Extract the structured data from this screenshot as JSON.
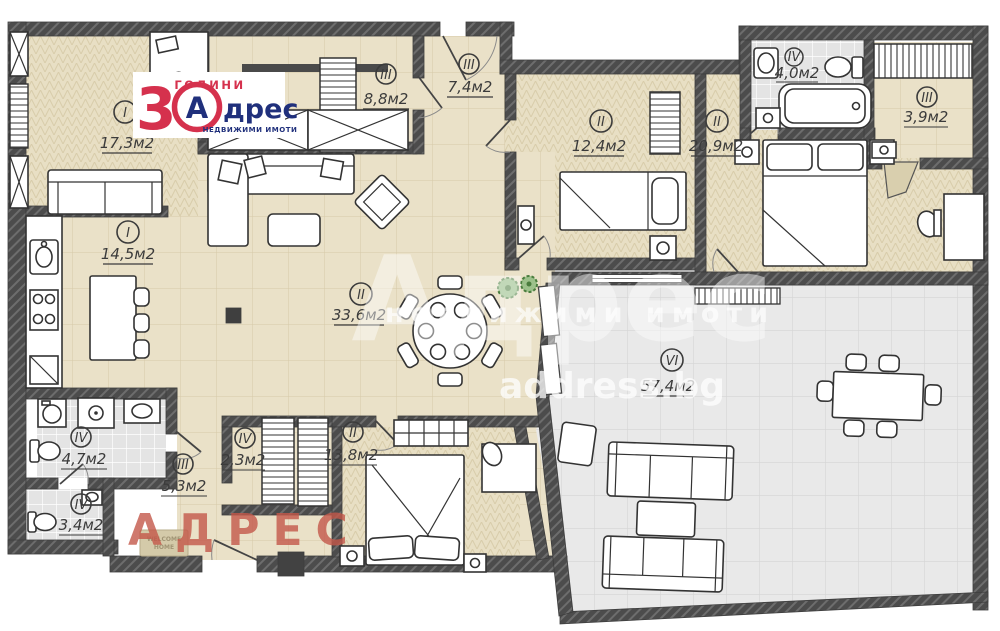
{
  "plan": {
    "rooms": [
      {
        "numeral": "I",
        "area": "17,3м2"
      },
      {
        "numeral": "III",
        "area": "8,8м2"
      },
      {
        "numeral": "III",
        "area": "7,4м2"
      },
      {
        "numeral": "II",
        "area": "12,4м2"
      },
      {
        "numeral": "II",
        "area": "20,9м2"
      },
      {
        "numeral": "IV",
        "area": "4,0м2"
      },
      {
        "numeral": "III",
        "area": "3,9м2"
      },
      {
        "numeral": "I",
        "area": "14,5м2"
      },
      {
        "numeral": "II",
        "area": "33,6м2"
      },
      {
        "numeral": "VI",
        "area": "57,4м2"
      },
      {
        "numeral": "IV",
        "area": "4,7м2"
      },
      {
        "numeral": "IV",
        "area": "2,3м2"
      },
      {
        "numeral": "III",
        "area": "5,3м2"
      },
      {
        "numeral": "IV",
        "area": "3,4м2"
      },
      {
        "numeral": "II",
        "area": "13,8м2"
      }
    ]
  },
  "logo": {
    "years_number": "3",
    "years_word": "ГОДИНИ",
    "brand_initial": "А",
    "brand_rest": "дрес",
    "tagline": "НЕДВИЖИМИ ИМОТИ"
  },
  "watermarks": {
    "brand_large": "Адрес",
    "tagline": "недвижими имоти",
    "website": "address.bg",
    "stamp": "АДРЕС",
    "doormat_line1": "WELCOME",
    "doormat_line2": "HOME"
  },
  "colors": {
    "logo_red": "#d5314d",
    "logo_navy": "#20307c",
    "stamp_red": "#c4584a",
    "plant_green": "#4a7d3e",
    "wall_gray": "#4c4c4c",
    "floor_beige": "#eae1c8",
    "floor_tile_gray": "#e6e6e6"
  }
}
